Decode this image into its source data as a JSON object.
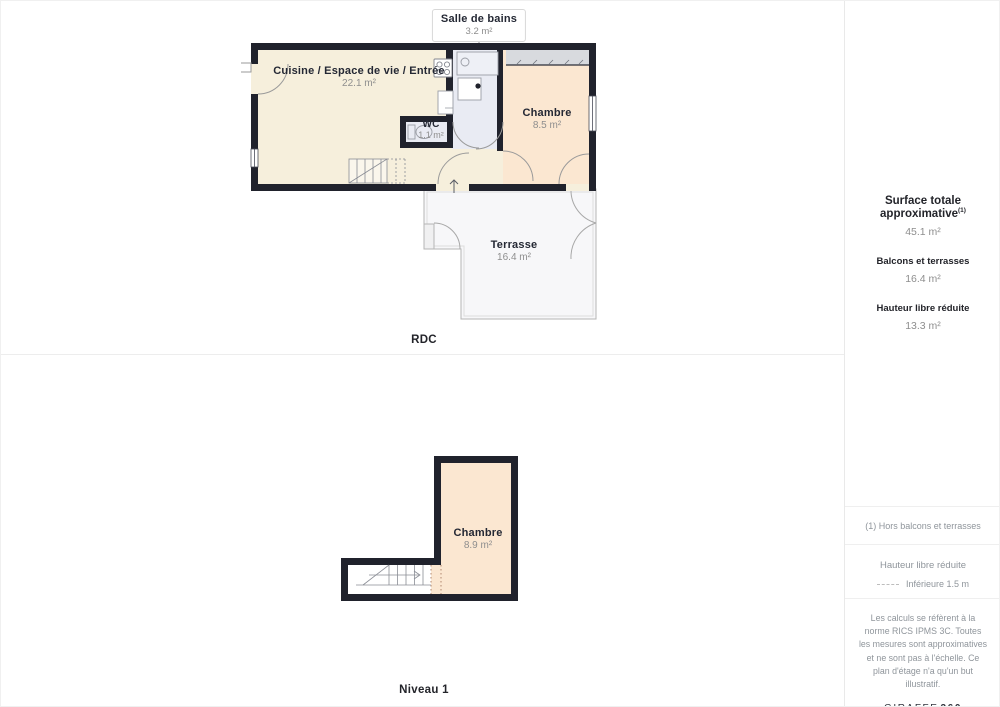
{
  "rdc": {
    "floor_label": "RDC",
    "callout": {
      "title": "Salle de bains",
      "area": "3.2 m²"
    },
    "kitchen": {
      "name": "Cuisine / Espace de vie / Entrée",
      "area": "22.1 m²"
    },
    "bedroom": {
      "name": "Chambre",
      "area": "8.5 m²"
    },
    "wc": {
      "name": "WC",
      "area": "1.1 m²"
    },
    "terrace": {
      "name": "Terrasse",
      "area": "16.4 m²"
    }
  },
  "niveau1": {
    "floor_label": "Niveau 1",
    "bedroom": {
      "name": "Chambre",
      "area": "8.9 m²"
    }
  },
  "sidebar": {
    "surface_total_label": "Surface totale approximative",
    "surface_total_sup": "(1)",
    "surface_total_value": "45.1 m²",
    "balconies_label": "Balcons et terrasses",
    "balconies_value": "16.4 m²",
    "reduced_label": "Hauteur libre réduite",
    "reduced_value": "13.3 m²",
    "footnote": "(1) Hors balcons et terrasses",
    "legend_title": "Hauteur libre réduite",
    "legend_item": "Inférieure 1.5 m",
    "disclaimer": "Les calculs se réfèrent à la norme RICS IPMS 3C. Toutes les mesures sont approximatives et ne sont pas à l'échelle. Ce plan d'étage n'a qu'un but illustratif.",
    "logo_brand": "GIRAFFE",
    "logo_suffix": "360"
  },
  "colors": {
    "wall": "#20222c",
    "kitchen_fill": "#f6efdc",
    "bedroom_fill": "#fbe7d1",
    "bath_fill": "#e9ebf3",
    "closet_fill": "#d8dade",
    "terrace_fill": "#f7f7f9",
    "muted_text": "#8e8e8e"
  }
}
